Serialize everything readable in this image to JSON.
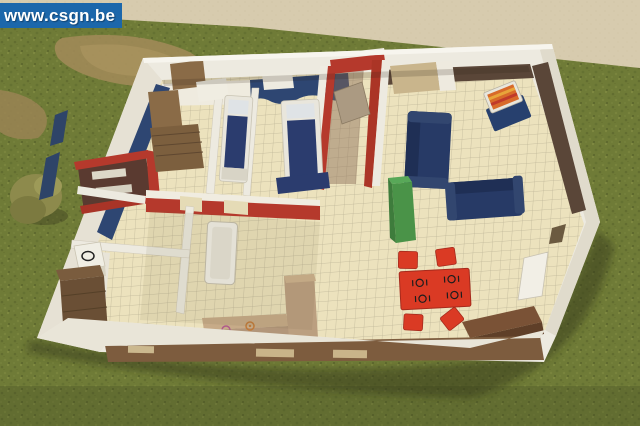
{
  "watermark": {
    "text": "www.csgn.be",
    "bg": "#1c67ab",
    "fg": "#ffffff"
  },
  "colors": {
    "backdrop": "#d7cbae",
    "grass": "#6f7b37",
    "grass_dark": "#57622b",
    "grass_light": "#8b9449",
    "path": "#a08a58",
    "bush": "#8d8a4c",
    "wall_white": "#edeae0",
    "wall_shade": "#e0dbcc",
    "wall_navy": "#2e4672",
    "wall_red": "#b5392c",
    "wall_brown_dark": "#5a4638",
    "cardboard": "#7d5c3e",
    "floor": "#ece2bd",
    "tile_line": "#b3ab8f",
    "sofa_navy": "#273a66",
    "bed_navy": "#2b3c6e",
    "table_red": "#da3a24",
    "cabinet_green": "#4a9348",
    "wood_brown": "#8a6b47",
    "wood_dark": "#6a4f35",
    "counter_tan": "#b2967a",
    "tv_orange": "#d86a2a",
    "alcove_dark": "#5a3a30"
  }
}
